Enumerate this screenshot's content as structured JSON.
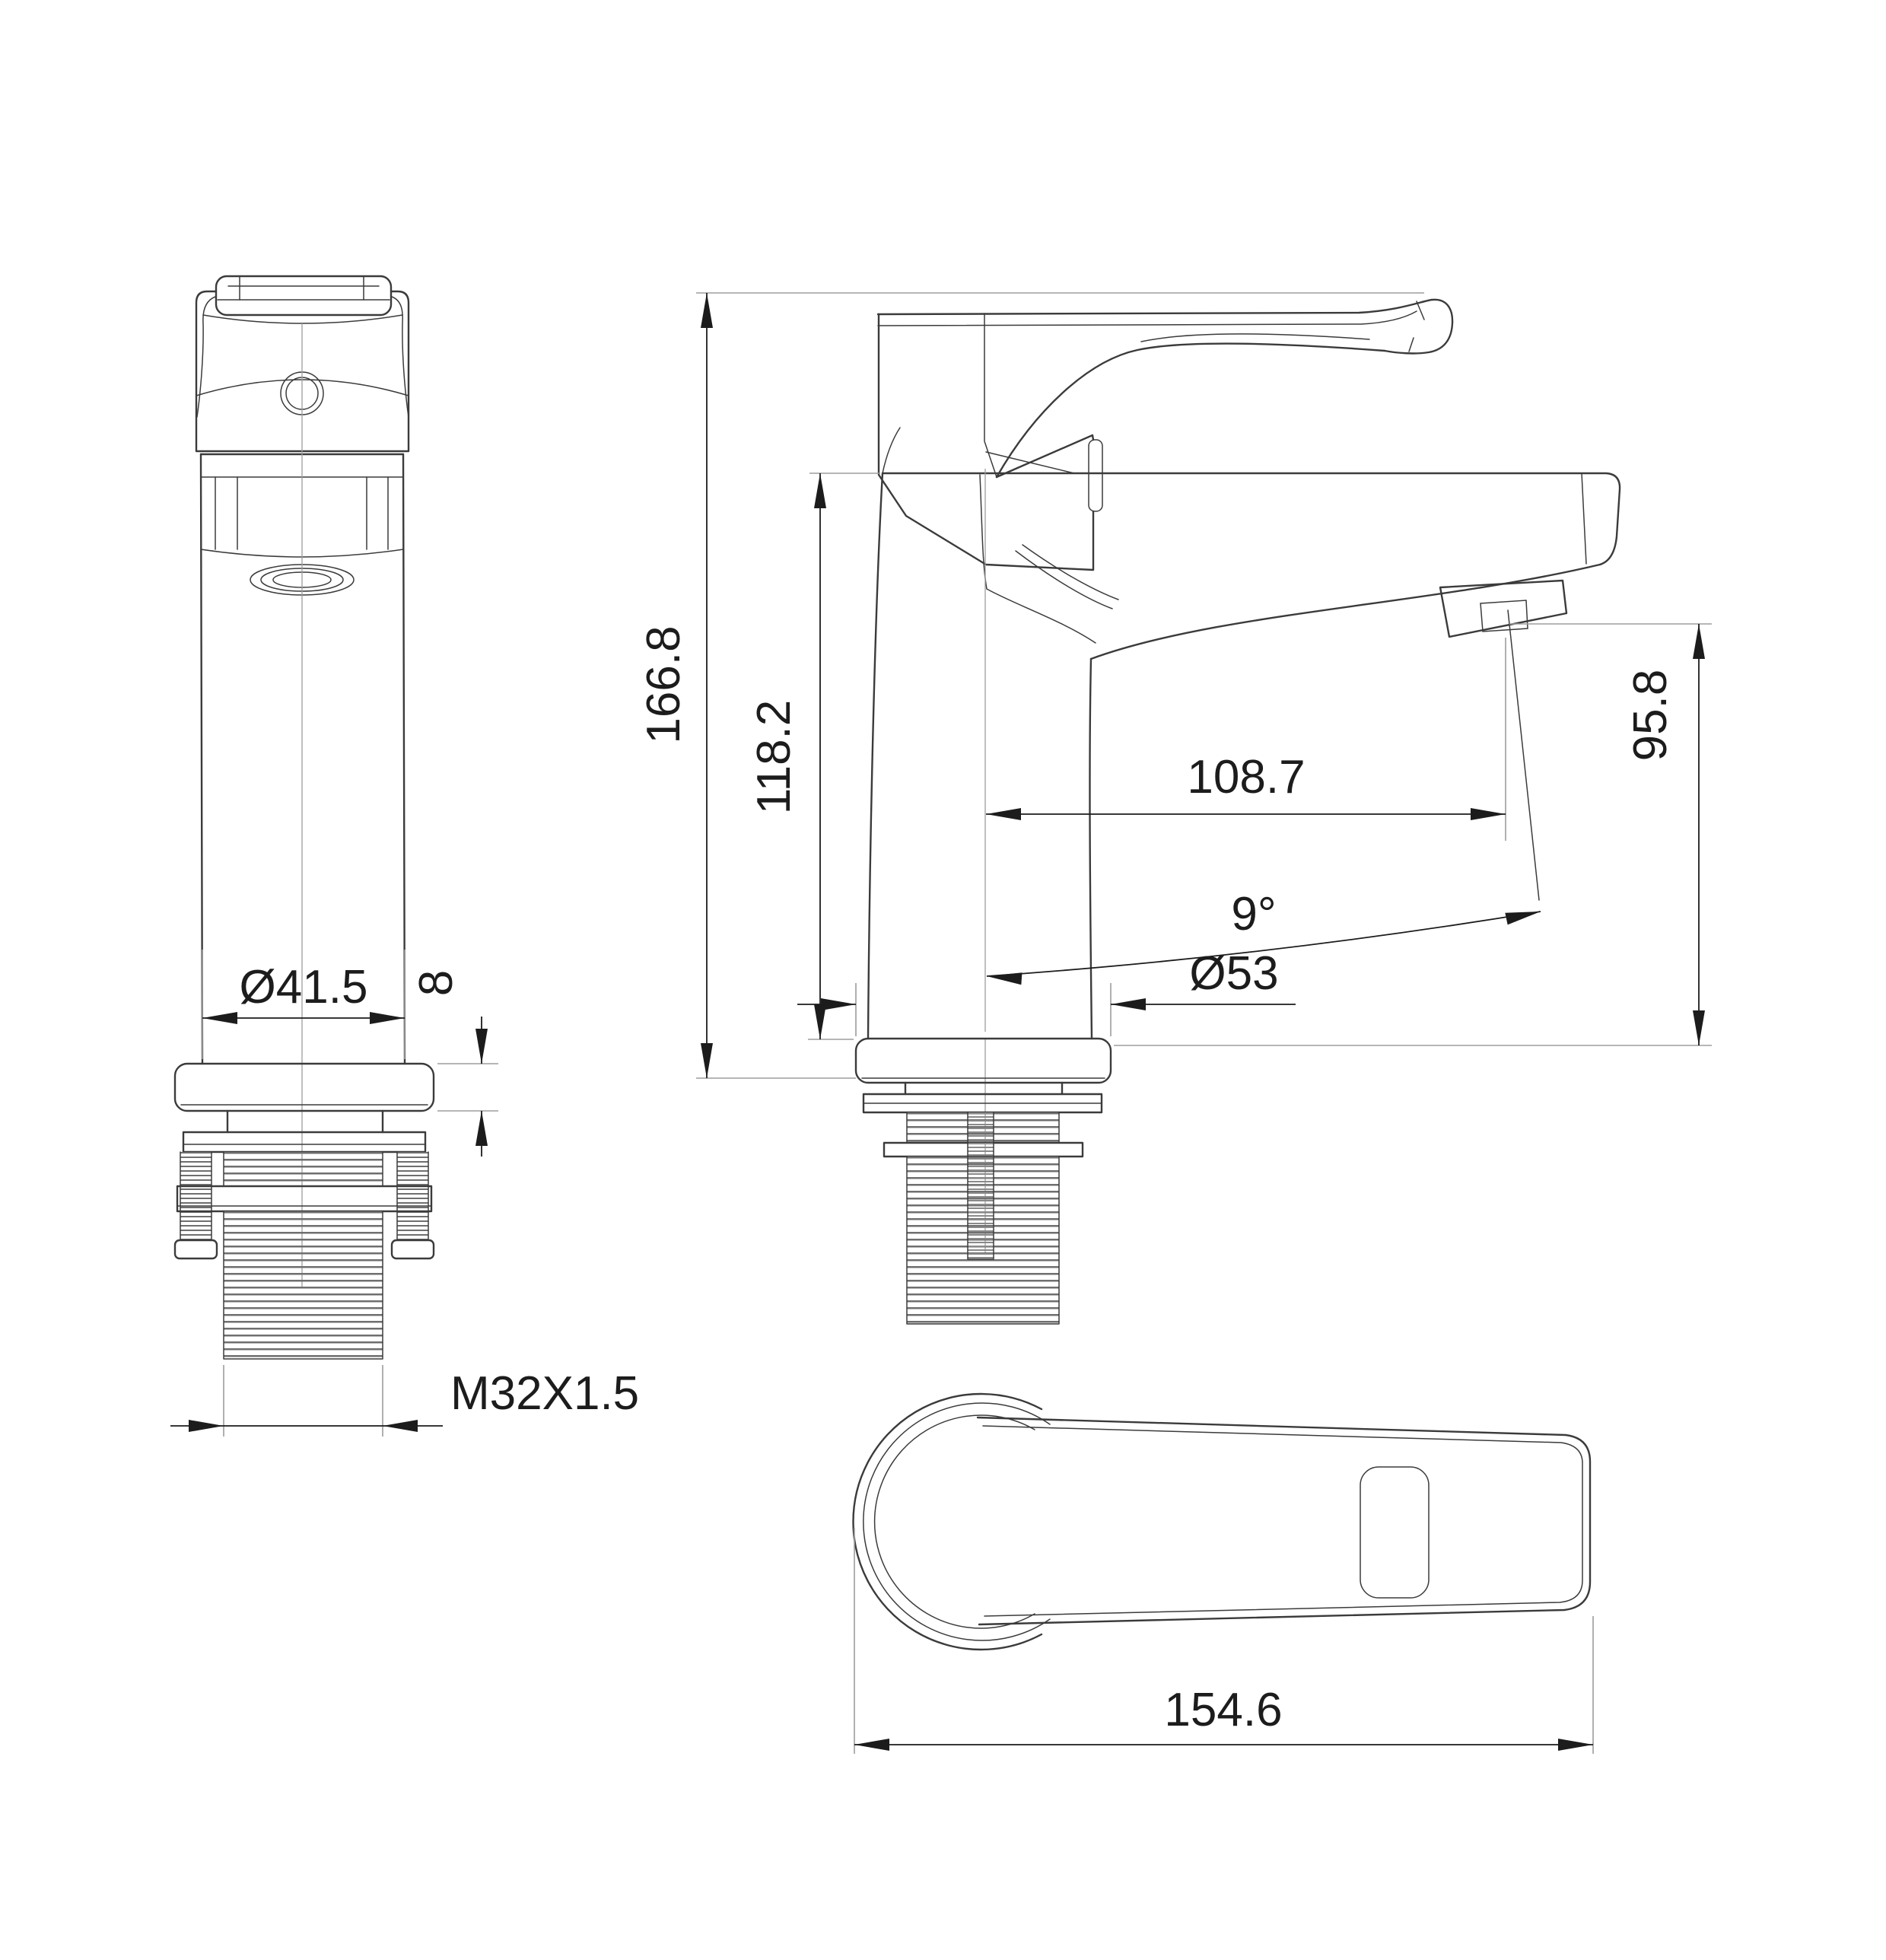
{
  "drawing": {
    "kind": "technical-dimension-drawing",
    "subject": "single-lever basin faucet, three orthographic views",
    "colors": {
      "background": "#ffffff",
      "object_lines": "#3b3b3b",
      "dimension_lines": "#1c1c1c",
      "extension_lines": "#9d9d9d"
    }
  },
  "dims": {
    "overall_height": {
      "label": "166.8"
    },
    "body_height": {
      "label": "118.2"
    },
    "spout_reach": {
      "label": "108.7"
    },
    "spout_angle": {
      "label": "9°"
    },
    "outlet_height": {
      "label": "95.8"
    },
    "body_diameter": {
      "label": "Ø41.5"
    },
    "flange_height": {
      "label": "8"
    },
    "base_diameter": {
      "label": "Ø53"
    },
    "thread_spec": {
      "label": "M32X1.5"
    },
    "handle_length": {
      "label": "154.6"
    }
  }
}
